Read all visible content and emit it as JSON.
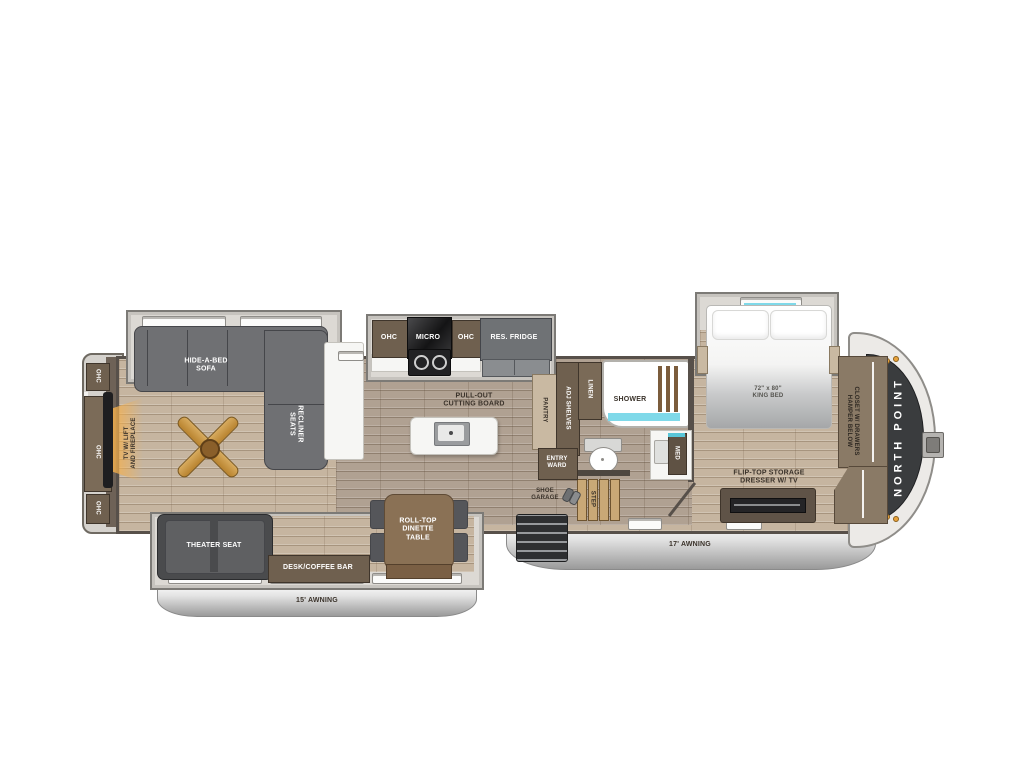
{
  "plan": {
    "brand": "NORTH POINT",
    "awnings": {
      "left": "15' AWNING",
      "right": "17' AWNING"
    },
    "labels": {
      "ohc": "OHC",
      "micro": "MICRO",
      "res_fridge": "RES. FRIDGE",
      "sofa_l1": "HIDE-A-BED",
      "sofa_l2": "SOFA",
      "recliner_l1": "RECLINER",
      "recliner_l2": "SEATS",
      "tv_l1": "TV W/ LIFT",
      "tv_l2": "AND FIREPLACE",
      "pullout_l1": "PULL-OUT",
      "pullout_l2": "CUTTING BOARD",
      "pantry": "PANTRY",
      "adj_shelves": "ADJ SHELVES",
      "linen": "LINEN",
      "shower": "SHOWER",
      "med": "MED",
      "entry_l1": "ENTRY",
      "entry_l2": "WARD",
      "shoe_l1": "SHOE",
      "shoe_l2": "GARAGE",
      "step": "STEP",
      "bed_l1": "72\" x 80\"",
      "bed_l2": "KING BED",
      "closet_l1": "CLOSET W/ DRAWERS",
      "closet_l2": "HAMPER BELOW",
      "dresser_l1": "FLIP-TOP STORAGE",
      "dresser_l2": "DRESSER W/ TV",
      "theater": "THEATER SEAT",
      "desk": "DESK/COFFEE BAR",
      "dinette_l1": "ROLL-TOP",
      "dinette_l2": "DINETTE",
      "dinette_l3": "TABLE"
    },
    "icons": {
      "fan": "ceiling-fan-icon",
      "clothes": "clothes-icon",
      "sink": "sink-icon",
      "toilet": "toilet-icon",
      "range": "range-burners-icon",
      "shoes": "shoes-icon",
      "hitch": "hitch-pin-icon",
      "marker_lights": "marker-lights-icon"
    },
    "colors": {
      "floor_light": "#c6b5a0",
      "floor_mid": "#b0a192",
      "wall": "#57504a",
      "cabinet_brown": "#6f604f",
      "cabinet_tan": "#c9b9a2",
      "furniture_gray": "#6f7073",
      "furniture_dark": "#4a4b4d",
      "slide_gray": "#dcd9d4",
      "counter_white": "#f6f6f4",
      "accent_cyan": "#7fd9e9",
      "fan_wood": "#c59347",
      "fireplace_glow": "#f5b04c",
      "cap_dark": "#3a3c3e",
      "awning_silver": "#9a9a9a",
      "clothes_blue": "#45b4e4",
      "clothes_tan": "#f0cfae",
      "clothes_purple": "#b0a6e0"
    }
  }
}
